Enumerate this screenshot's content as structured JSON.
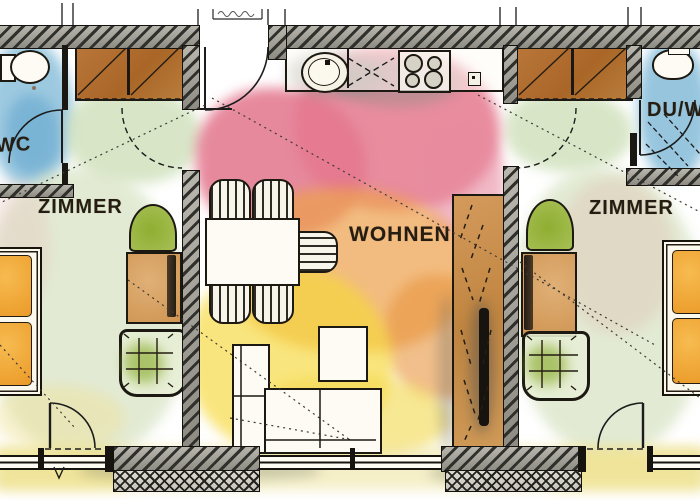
{
  "title": "Apartment floor plan (watercolor)",
  "rooms": {
    "wc_left": {
      "label": "WC"
    },
    "bedroom_left": {
      "label": "ZIMMER"
    },
    "living": {
      "label": "WOHNEN"
    },
    "bedroom_right": {
      "label": "ZIMMER"
    },
    "bath_right": {
      "label": "DU/WC"
    }
  },
  "palette": {
    "wash_pink": "#e5788e",
    "wash_orange": "#eda14b",
    "wash_yellow": "#f6d839",
    "wash_green": "#d9e4c6",
    "wash_blue": "#85bcd9",
    "wardrobe_brown": "#b06e2d",
    "mattress_orange": "#f0a53a",
    "plant_green": "#9db83f",
    "armchair_tan": "#d8a262",
    "wall_hatch": "#30302c"
  }
}
